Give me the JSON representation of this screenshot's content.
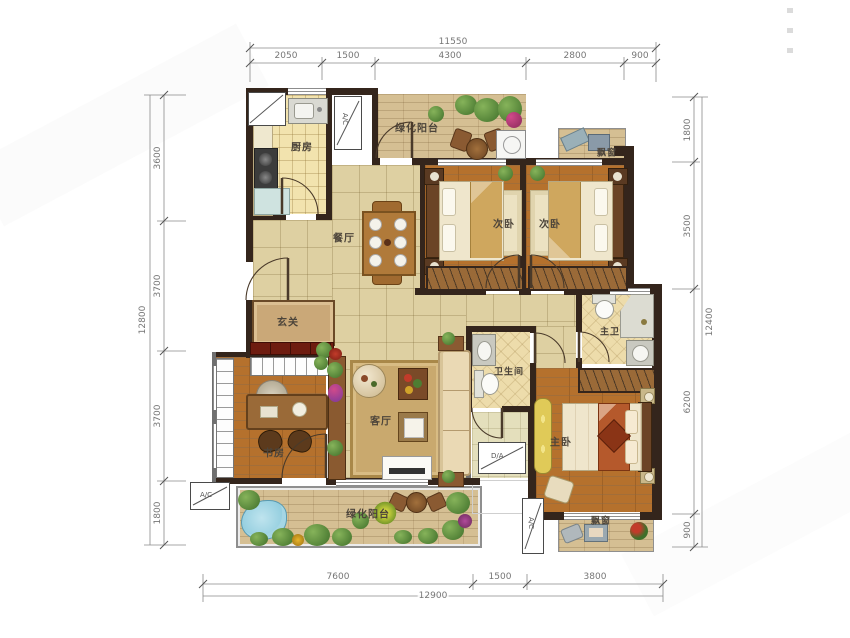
{
  "rooms": {
    "kitchen": "厨房",
    "balcony_top": "绿化阳台",
    "bedroom_a": "次卧",
    "bedroom_b": "次卧",
    "bay_top": "飘窗",
    "dining": "餐厅",
    "foyer": "玄关",
    "living": "客厅",
    "bathroom": "卫生间",
    "master_bath": "主卫",
    "master_bedroom": "主卧",
    "study": "书房",
    "balcony_bottom": "绿化阳台",
    "bay_bottom": "飘窗"
  },
  "dims": {
    "top": {
      "total": "11550",
      "segments": [
        "2050",
        "1500",
        "4300",
        "2800",
        "900"
      ]
    },
    "left": {
      "total": "12800",
      "segments": [
        "3600",
        "3700",
        "3700",
        "1800"
      ]
    },
    "right": {
      "total": "12400",
      "segments": [
        "1800",
        "3500",
        "6200",
        "900"
      ]
    },
    "bottom": {
      "total": "12900",
      "segments": [
        "7600",
        "1500",
        "3800"
      ]
    }
  },
  "symbols": {
    "ac": "A/C",
    "da": "D/A"
  },
  "colors": {
    "wall": "#34251c",
    "wood": "#b5712d",
    "tile": "#ded0a2",
    "balcony": "#d5bf93",
    "accent_red": "#6e1c10"
  }
}
